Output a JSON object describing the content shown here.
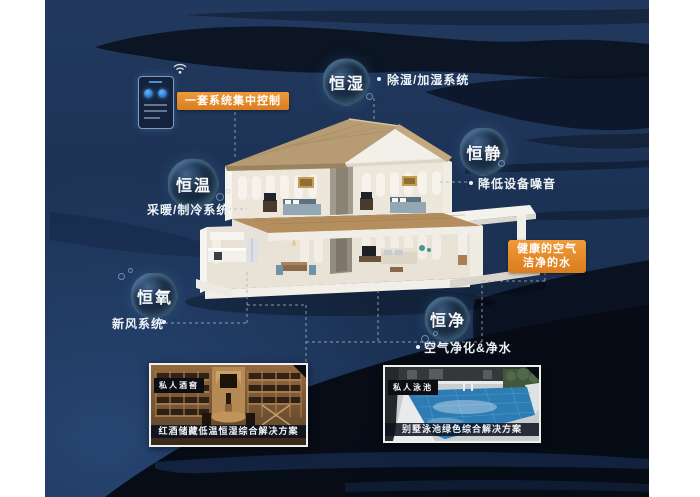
{
  "poster": {
    "control_label": "一套系统集中控制",
    "highlight_label": {
      "line1": "健康的空气",
      "line2": "洁净的水"
    }
  },
  "bubbles": [
    {
      "id": "humidity",
      "label": "恒湿",
      "caption": "除湿/加湿系统"
    },
    {
      "id": "quiet",
      "label": "恒静",
      "caption": "降低设备噪音"
    },
    {
      "id": "temperature",
      "label": "恒温",
      "caption": "采暖/制冷系统"
    },
    {
      "id": "oxygen",
      "label": "恒氧",
      "caption": "新风系统"
    },
    {
      "id": "clean",
      "label": "恒净",
      "caption": "空气净化&净水"
    }
  ],
  "panels": [
    {
      "tag": "私人酒窖",
      "caption": "红酒储藏低温恒湿综合解决方案"
    },
    {
      "tag": "私人泳池",
      "caption": "别墅泳池绿色综合解决方案"
    }
  ],
  "colors": {
    "accent": "#e08427",
    "background_navy": "#1c3153",
    "dark_wave": "#080d18"
  }
}
